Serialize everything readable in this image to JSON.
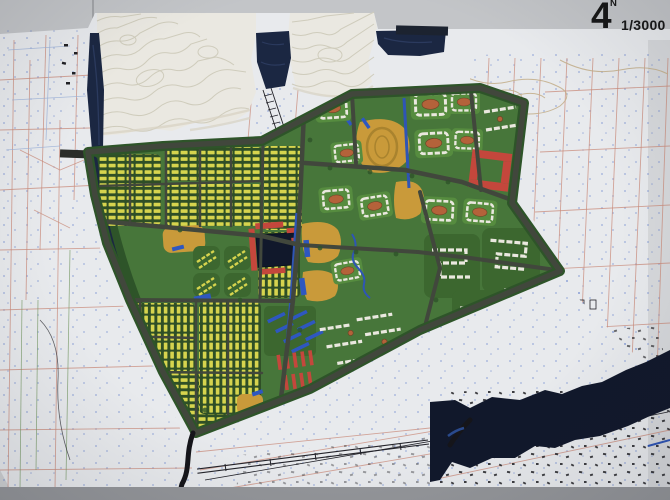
{
  "annotations": {
    "north_label": "N",
    "figure_number": "4",
    "scale": "1/3000"
  },
  "palette": {
    "wall": "#c3c5c8",
    "wall-shade": "#94969a",
    "paper": "#e8eaed",
    "terrain": "#eae8e1",
    "terrain-line": "#cfccbc",
    "terrain-shade": "#d7d2c2",
    "water": "#1b2742",
    "water-deep": "#11182b",
    "water-blue": "#2f55b5",
    "road": "#41473c",
    "green": "#47763a",
    "green-dark": "#2e5429",
    "green-block": "#568c3f",
    "yellow": "#d6d44e",
    "ochre": "#c99a3a",
    "ochre-court": "#b4623a",
    "red": "#c4473c",
    "blue-bldg": "#2e57c0",
    "white-bldg": "#eae8df",
    "pink-line": "#c98b7b",
    "blue-dot": "#5b79c9",
    "ink": "#23232a",
    "tan": "#c4b08d",
    "text": "#171717"
  },
  "legend": {
    "zones": [
      {
        "name": "row-housing-yellow",
        "color": "#d6d44e"
      },
      {
        "name": "slab-housing-white",
        "color": "#eae8df"
      },
      {
        "name": "public-facility-ochre",
        "color": "#c99a3a"
      },
      {
        "name": "commercial-red",
        "color": "#c4473c"
      },
      {
        "name": "special-blue",
        "color": "#2e57c0"
      },
      {
        "name": "park-greenbelt",
        "color": "#2e5429"
      },
      {
        "name": "water",
        "color": "#1b2742"
      },
      {
        "name": "terrain-model-contours",
        "color": "#eae8e1"
      }
    ]
  }
}
